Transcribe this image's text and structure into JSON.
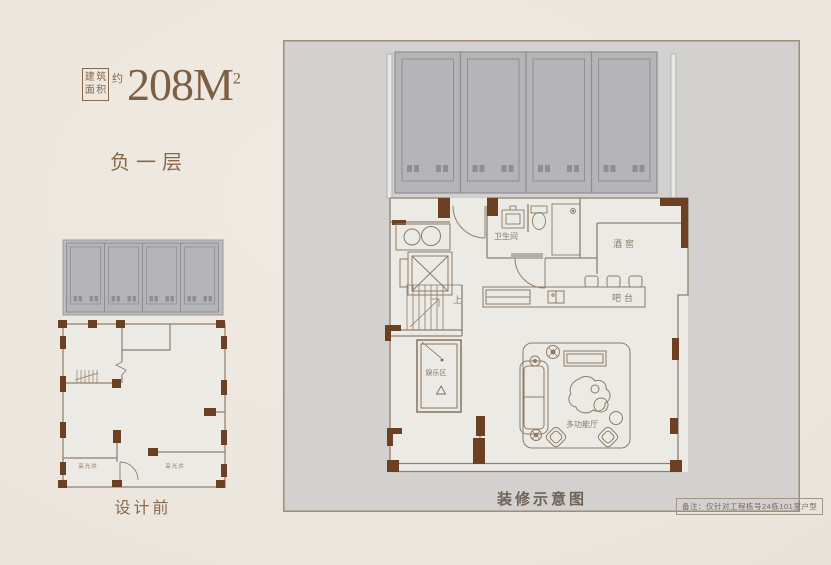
{
  "colors": {
    "page_bg": "#ebe6dd",
    "accent_brown": "#8a684a",
    "area_value_brown": "#7d5f43",
    "wall_line": "#907f6c",
    "wall_pier_dark": "#6b4023",
    "parking_fill": "#b5b5b8",
    "parking_stroke": "#8f8f93",
    "frame_bg": "#d2d1cf",
    "interior_fill": "#eceae5",
    "caption_dark": "#6f6355"
  },
  "header": {
    "area_box_chars": [
      "建",
      "筑",
      "面",
      "积"
    ],
    "area_about": "约",
    "area_value": "208M",
    "area_sup": "2",
    "floor_label": "负一层"
  },
  "before_plan": {
    "caption": "设计前",
    "light_well_left": "采光井",
    "light_well_right": "采光井"
  },
  "after_plan": {
    "caption": "装修示意图",
    "note": "备注：仅针对工程栋号24栋101室户型",
    "labels": {
      "bathroom": "卫生间",
      "wine_cellar": "酒窖",
      "bar": "吧台",
      "entertainment_zone": "娱乐区",
      "multi_function_hall": "多功能厅",
      "stairs_up": "上"
    }
  }
}
